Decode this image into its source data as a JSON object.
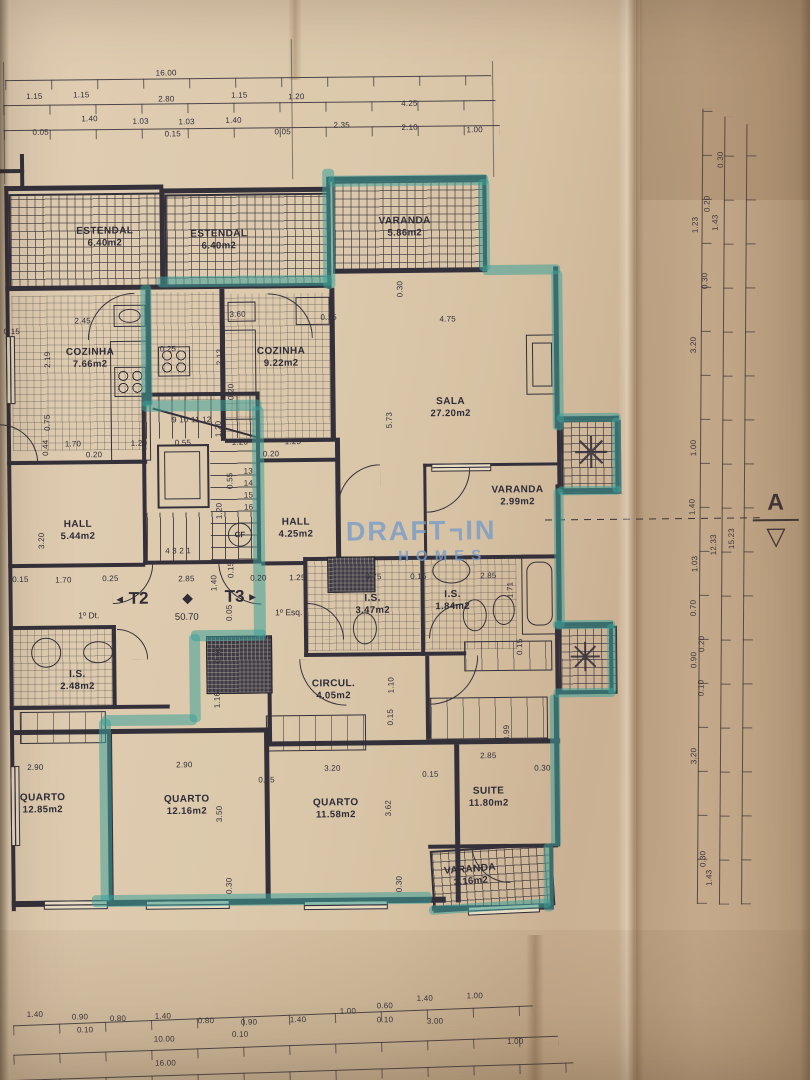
{
  "title": "Planta de piso — T2 / T3 (1º andar)",
  "watermark": {
    "brand_top": "DRAFT",
    "brand_mid": "IN",
    "brand_bottom": "HOMES"
  },
  "section_marker": {
    "label": "A"
  },
  "entrance": {
    "t2": "T2",
    "t3": "T3",
    "t2_unit": "1º Dt.",
    "t3_unit": "1º Esq.",
    "level": "50.70",
    "cf": "CF"
  },
  "stairs": {
    "top_row": "9 10 11 12",
    "bottom_row": "4 3 2 1",
    "right_column": [
      "13",
      "14",
      "15",
      "16"
    ]
  },
  "icons": {
    "plant": "✳",
    "diamond": "◆",
    "arrow_left": "◄",
    "arrow_right": "►",
    "section_triangle": "▽"
  },
  "colors": {
    "paper": "#dbc9ad",
    "paper_shadow": "#c2a98b",
    "ink": "#33303a",
    "highlight": "#3ea099",
    "watermark": "#769bc8"
  },
  "room_labels": [
    {
      "name": "ESTENDAL",
      "area": "6.40m2",
      "x": 108,
      "y": 234
    },
    {
      "name": "ESTENDAL",
      "area": "6.40m2",
      "x": 222,
      "y": 238
    },
    {
      "name": "VARANDA",
      "area": "5.86m2",
      "x": 408,
      "y": 227
    },
    {
      "name": "COZINHA",
      "area": "7.66m2",
      "x": 92,
      "y": 355
    },
    {
      "name": "COZINHA",
      "area": "9.22m2",
      "x": 283,
      "y": 356
    },
    {
      "name": "SALA",
      "area": "27.20m2",
      "x": 452,
      "y": 408
    },
    {
      "name": "VARANDA",
      "area": "2.99m2",
      "x": 518,
      "y": 497
    },
    {
      "name": "HALL",
      "area": "5.44m2",
      "x": 78,
      "y": 527
    },
    {
      "name": "HALL",
      "area": "4.25m2",
      "x": 296,
      "y": 527
    },
    {
      "name": "I.S.",
      "area": "2.48m2",
      "x": 76,
      "y": 677
    },
    {
      "name": "I.S.",
      "area": "3.47m2",
      "x": 372,
      "y": 604
    },
    {
      "name": "I.S.",
      "area": "1.84m2",
      "x": 452,
      "y": 601
    },
    {
      "name": "CIRCUL.",
      "area": "4.05m2",
      "x": 332,
      "y": 689
    },
    {
      "name": "QUARTO",
      "area": "12.85m2",
      "x": 40,
      "y": 800
    },
    {
      "name": "QUARTO",
      "area": "12.16m2",
      "x": 184,
      "y": 803
    },
    {
      "name": "QUARTO",
      "area": "11.58m2",
      "x": 333,
      "y": 808
    },
    {
      "name": "SUITE",
      "area": "11.80m2",
      "x": 486,
      "y": 798
    },
    {
      "name": "VARANDA",
      "area": "3.16m2",
      "x": 467,
      "y": 876,
      "rot": -4
    }
  ],
  "dim_labels": [
    {
      "v": "16.00",
      "x": 171,
      "y": 71
    },
    {
      "v": "1.15",
      "x": 39,
      "y": 93
    },
    {
      "v": "1.15",
      "x": 86,
      "y": 92
    },
    {
      "v": "2.80",
      "x": 171,
      "y": 97
    },
    {
      "v": "1.15",
      "x": 244,
      "y": 94
    },
    {
      "v": "1.20",
      "x": 301,
      "y": 96
    },
    {
      "v": "4.25",
      "x": 414,
      "y": 104
    },
    {
      "v": "0.05",
      "x": 45,
      "y": 129
    },
    {
      "v": "1.40",
      "x": 94,
      "y": 116
    },
    {
      "v": "1.03",
      "x": 145,
      "y": 119
    },
    {
      "v": "0.15",
      "x": 177,
      "y": 132
    },
    {
      "v": "1.03",
      "x": 191,
      "y": 120
    },
    {
      "v": "1.40",
      "x": 238,
      "y": 119
    },
    {
      "v": "0.05",
      "x": 287,
      "y": 131
    },
    {
      "v": "2.35",
      "x": 346,
      "y": 125
    },
    {
      "v": "2.10",
      "x": 414,
      "y": 128
    },
    {
      "v": "1.00",
      "x": 479,
      "y": 131
    },
    {
      "v": "0.15",
      "x": 14,
      "y": 328
    },
    {
      "v": "2.45",
      "x": 85,
      "y": 318
    },
    {
      "v": "0.25",
      "x": 170,
      "y": 347
    },
    {
      "v": "3.60",
      "x": 240,
      "y": 313
    },
    {
      "v": "0.15",
      "x": 331,
      "y": 317
    },
    {
      "v": "4.75",
      "x": 450,
      "y": 320
    },
    {
      "v": "2.19",
      "x": 50,
      "y": 356,
      "r": 1
    },
    {
      "v": "2.13",
      "x": 222,
      "y": 355,
      "r": 1
    },
    {
      "v": "0.20",
      "x": 233,
      "y": 390,
      "r": 1
    },
    {
      "v": "0.30",
      "x": 403,
      "y": 289,
      "r": 1
    },
    {
      "v": "5.73",
      "x": 391,
      "y": 420,
      "r": 1
    },
    {
      "v": "1.20",
      "x": 220,
      "y": 427,
      "r": 1
    },
    {
      "v": "0.55",
      "x": 231,
      "y": 479,
      "r": 1
    },
    {
      "v": "1.20",
      "x": 220,
      "y": 509,
      "r": 1
    },
    {
      "v": "1.70",
      "x": 74,
      "y": 441
    },
    {
      "v": "1.20",
      "x": 140,
      "y": 441
    },
    {
      "v": "0.55",
      "x": 184,
      "y": 441
    },
    {
      "v": "1.20",
      "x": 241,
      "y": 441
    },
    {
      "v": "1.25",
      "x": 294,
      "y": 441
    },
    {
      "v": "0.20",
      "x": 95,
      "y": 452
    },
    {
      "v": "0.20",
      "x": 272,
      "y": 453
    },
    {
      "v": "0.75",
      "x": 49,
      "y": 419,
      "r": 1
    },
    {
      "v": "0.44",
      "x": 47,
      "y": 444,
      "r": 1
    },
    {
      "v": "3.20",
      "x": 42,
      "y": 537,
      "r": 1
    },
    {
      "v": "0.15",
      "x": 20,
      "y": 576
    },
    {
      "v": "1.70",
      "x": 63,
      "y": 577
    },
    {
      "v": "0.25",
      "x": 110,
      "y": 576
    },
    {
      "v": "2.85",
      "x": 186,
      "y": 577
    },
    {
      "v": "1.40",
      "x": 214,
      "y": 581,
      "r": 1
    },
    {
      "v": "0.15",
      "x": 231,
      "y": 568,
      "r": 1
    },
    {
      "v": "0.20",
      "x": 258,
      "y": 577
    },
    {
      "v": "1.25",
      "x": 297,
      "y": 577
    },
    {
      "v": "0.75",
      "x": 373,
      "y": 577
    },
    {
      "v": "0.15",
      "x": 418,
      "y": 577
    },
    {
      "v": "2.85",
      "x": 488,
      "y": 577
    },
    {
      "v": "1.71",
      "x": 510,
      "y": 591,
      "r": 1
    },
    {
      "v": "0.15",
      "x": 519,
      "y": 648,
      "r": 1
    },
    {
      "v": "0.05",
      "x": 229,
      "y": 611,
      "r": 1
    },
    {
      "v": "0.60",
      "x": 217,
      "y": 653,
      "r": 1
    },
    {
      "v": "1.16",
      "x": 216,
      "y": 698,
      "r": 1
    },
    {
      "v": "1.10",
      "x": 390,
      "y": 685,
      "r": 1
    },
    {
      "v": "0.15",
      "x": 389,
      "y": 717,
      "r": 1
    },
    {
      "v": "3.99",
      "x": 505,
      "y": 734,
      "r": 1
    },
    {
      "v": "2.90",
      "x": 33,
      "y": 764
    },
    {
      "v": "2.90",
      "x": 182,
      "y": 763
    },
    {
      "v": "0.15",
      "x": 264,
      "y": 779
    },
    {
      "v": "3.20",
      "x": 330,
      "y": 768
    },
    {
      "v": "0.15",
      "x": 428,
      "y": 775
    },
    {
      "v": "2.85",
      "x": 486,
      "y": 757
    },
    {
      "v": "0.30",
      "x": 540,
      "y": 770
    },
    {
      "v": "3.50",
      "x": 217,
      "y": 812,
      "r": 1
    },
    {
      "v": "3.62",
      "x": 386,
      "y": 808,
      "r": 1
    },
    {
      "v": "0.30",
      "x": 226,
      "y": 884,
      "r": 1
    },
    {
      "v": "0.30",
      "x": 396,
      "y": 884,
      "r": 1
    },
    {
      "v": "1.40",
      "x": 30,
      "y": 1011
    },
    {
      "v": "0.90",
      "x": 75,
      "y": 1014
    },
    {
      "v": "0.10",
      "x": 80,
      "y": 1027
    },
    {
      "v": "0.80",
      "x": 113,
      "y": 1016
    },
    {
      "v": "1.40",
      "x": 158,
      "y": 1014
    },
    {
      "v": "0.80",
      "x": 201,
      "y": 1019
    },
    {
      "v": "0.90",
      "x": 244,
      "y": 1021
    },
    {
      "v": "0.10",
      "x": 235,
      "y": 1033
    },
    {
      "v": "1.40",
      "x": 293,
      "y": 1019
    },
    {
      "v": "1.00",
      "x": 343,
      "y": 1011
    },
    {
      "v": "0.60",
      "x": 380,
      "y": 1006
    },
    {
      "v": "0.10",
      "x": 380,
      "y": 1020
    },
    {
      "v": "1.40",
      "x": 420,
      "y": 999
    },
    {
      "v": "1.00",
      "x": 470,
      "y": 997
    },
    {
      "v": "10.00",
      "x": 159,
      "y": 1037
    },
    {
      "v": "3.00",
      "x": 430,
      "y": 1022
    },
    {
      "v": "1.00",
      "x": 510,
      "y": 1043
    },
    {
      "v": "16.00",
      "x": 160,
      "y": 1061
    },
    {
      "v": "0.30",
      "x": 725,
      "y": 163,
      "r": 1
    },
    {
      "v": "0.20",
      "x": 711,
      "y": 207,
      "r": 1
    },
    {
      "v": "1.23",
      "x": 699,
      "y": 228,
      "r": 1
    },
    {
      "v": "1.43",
      "x": 719,
      "y": 226,
      "r": 1
    },
    {
      "v": "0.30",
      "x": 708,
      "y": 284,
      "r": 1
    },
    {
      "v": "3.20",
      "x": 696,
      "y": 348,
      "r": 1
    },
    {
      "v": "1.00",
      "x": 695,
      "y": 451,
      "r": 1
    },
    {
      "v": "1.40",
      "x": 693,
      "y": 510,
      "r": 1
    },
    {
      "v": "12.33",
      "x": 714,
      "y": 548,
      "r": 1
    },
    {
      "v": "15.23",
      "x": 732,
      "y": 542,
      "r": 1
    },
    {
      "v": "1.03",
      "x": 695,
      "y": 567,
      "r": 1
    },
    {
      "v": "0.70",
      "x": 693,
      "y": 611,
      "r": 1
    },
    {
      "v": "0.20",
      "x": 701,
      "y": 647,
      "r": 1
    },
    {
      "v": "0.90",
      "x": 693,
      "y": 663,
      "r": 1
    },
    {
      "v": "0.10",
      "x": 700,
      "y": 691,
      "r": 1
    },
    {
      "v": "3.20",
      "x": 692,
      "y": 759,
      "r": 1
    },
    {
      "v": "0.30",
      "x": 700,
      "y": 862,
      "r": 1
    },
    {
      "v": "1.43",
      "x": 706,
      "y": 881,
      "r": 1
    }
  ]
}
